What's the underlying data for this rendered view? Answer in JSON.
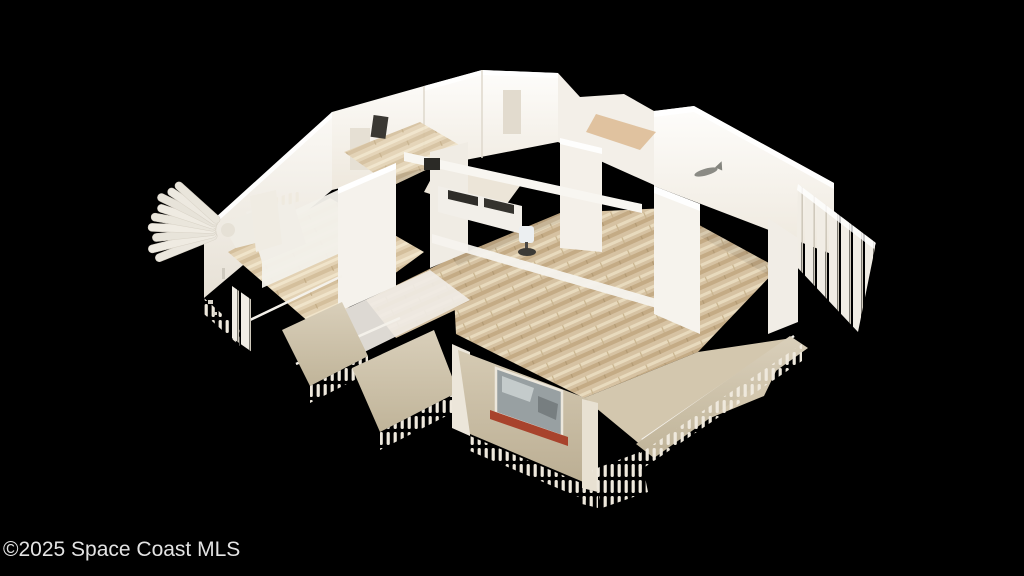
{
  "watermark": {
    "text": "©2025 Space Coast MLS",
    "color": "#e3e3e3"
  },
  "scene": {
    "type": "3d-dollhouse-scan",
    "description": "Overhead dollhouse view of a single-story home 3D scan with white walls, wood floors, and ragged scan-fringe edges on a black background",
    "background_color": "#000000",
    "colors": {
      "walls": "#f4f1eb",
      "walls_bright": "#fdfcf9",
      "wood_floor": "#d6c2a2",
      "wood_floor_light": "#e3d2b4",
      "kitchen_floor": "#ece5d8",
      "carpet": "#d3c7ae",
      "exterior_stucco": "#cdc1a8",
      "window_sill": "#a8432c",
      "window_glass": "#98a0a2",
      "dark_fixture": "#2f2d29",
      "fringe": "#efe9dd"
    }
  }
}
